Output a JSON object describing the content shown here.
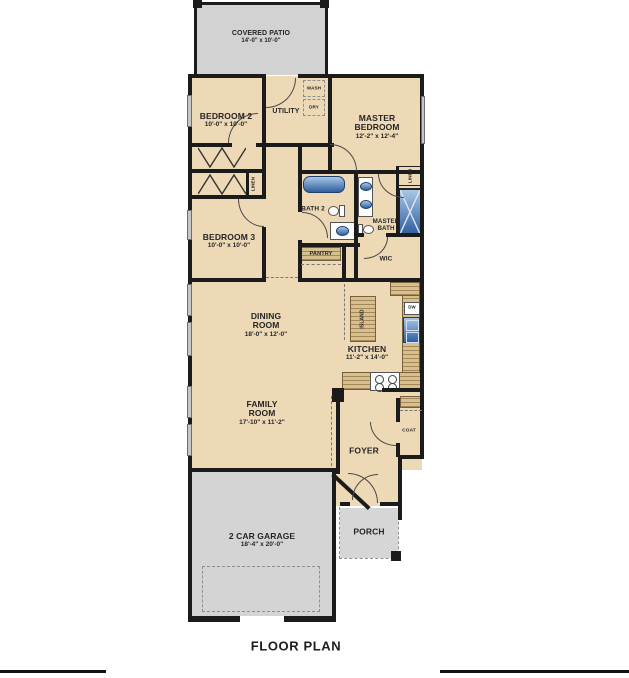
{
  "title": "FLOOR PLAN",
  "rooms": {
    "covered_patio": {
      "name": "COVERED PATIO",
      "dims": "14'-0\" x 10'-0\""
    },
    "bedroom2": {
      "name": "BEDROOM 2",
      "dims": "10'-0\" x 10'-0\""
    },
    "utility": {
      "name": "UTILITY"
    },
    "wash": {
      "name": "WASH"
    },
    "dry": {
      "name": "DRY"
    },
    "master_bedroom": {
      "name": "MASTER BEDROOM",
      "dims": "12'-2\" x 12'-4\""
    },
    "bath2": {
      "name": "BATH 2"
    },
    "master_bath": {
      "name": "MASTER BATH"
    },
    "linen_hall": {
      "name": "LINEN"
    },
    "linen_master": {
      "name": "LINEN"
    },
    "bedroom3": {
      "name": "BEDROOM 3",
      "dims": "10'-0\" x 10'-0\""
    },
    "pantry": {
      "name": "PANTRY"
    },
    "wic": {
      "name": "WIC"
    },
    "dining_room": {
      "name": "DINING ROOM",
      "dims": "18'-0\" x 12'-0\""
    },
    "kitchen": {
      "name": "KITCHEN",
      "dims": "11'-2\" x 14'-0\""
    },
    "island": {
      "name": "ISLAND"
    },
    "dw": {
      "name": "DW"
    },
    "family_room": {
      "name": "FAMILY ROOM",
      "dims": "17'-10\" x 11'-2\""
    },
    "foyer": {
      "name": "FOYER"
    },
    "coat": {
      "name": "COAT"
    },
    "porch": {
      "name": "PORCH"
    },
    "garage": {
      "name": "2 CAR GARAGE",
      "dims": "18'-4\" x 20'-0\""
    }
  },
  "colors": {
    "room_fill": "#edd9b5",
    "concrete": "#d3d3d3",
    "wall": "#1b1b1b",
    "fixture_blue": "#4479b8",
    "counter": "#d8bf90"
  }
}
